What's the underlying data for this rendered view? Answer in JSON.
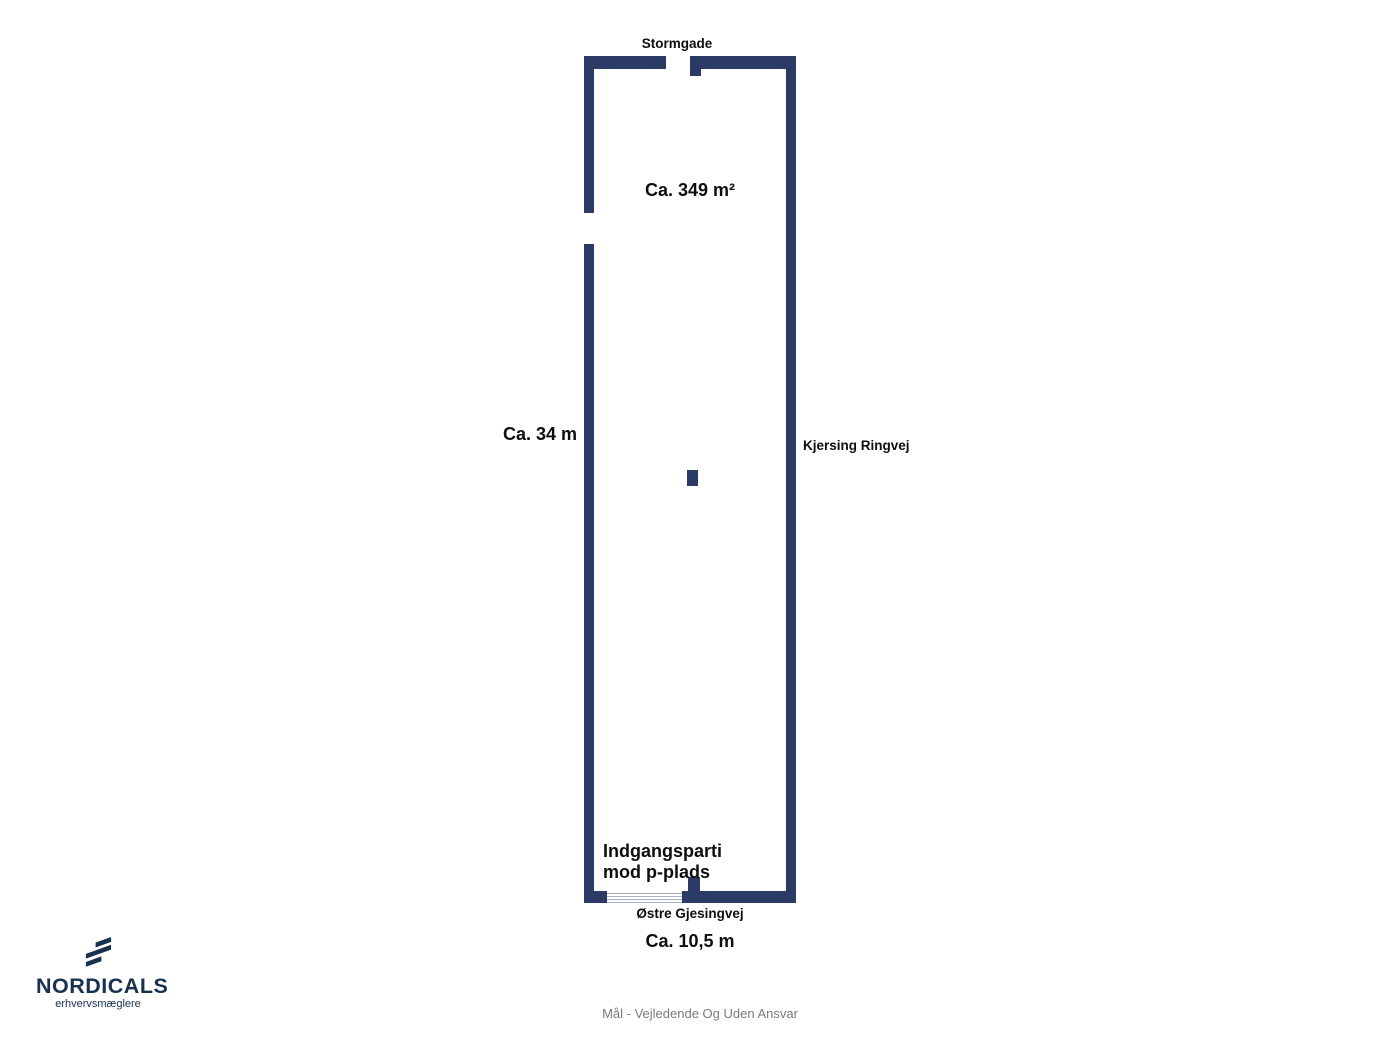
{
  "floorplan": {
    "area_label": "Ca. 349 m²",
    "height_label": "Ca. 34 m",
    "width_label": "Ca. 10,5 m",
    "street_top": "Stormgade",
    "street_right": "Kjersing Ringvej",
    "street_bottom": "Østre Gjesingvej",
    "entrance_line1": "Indgangsparti",
    "entrance_line2": "mod p-plads",
    "wall_color": "#2c3a66"
  },
  "branding": {
    "name": "NORDICALS",
    "tagline": "erhvervsmæglere",
    "color": "#17314f"
  },
  "footer": {
    "disclaimer": "Mål - Vejledende Og Uden Ansvar",
    "text_color": "#7b7b7b"
  }
}
